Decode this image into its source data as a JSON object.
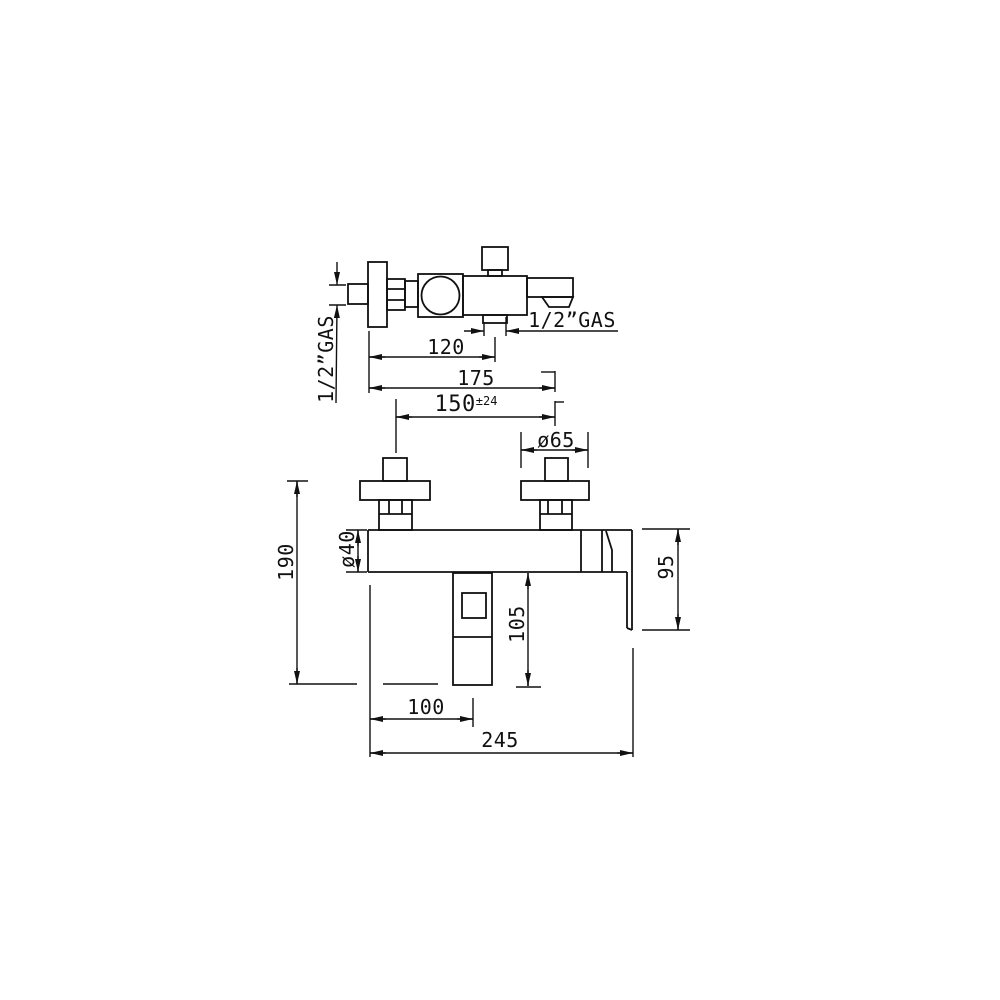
{
  "drawing_labels": {
    "inlet_connection_size": "1/2”GAS",
    "shower_outlet_connection_size": "1/2”GAS",
    "wall_to_shower_outlet_depth": "120",
    "wall_to_spout_depth": "175",
    "inlet_centers_distance": "150",
    "inlet_centers_tolerance": "±24",
    "rosette_diameter": "ø65",
    "body_diameter": "ø40",
    "overall_height": "190",
    "body_handle_height": "95",
    "outlet_drop_height": "105",
    "wall_to_outlet_center": "100",
    "overall_width": "245"
  },
  "style_colors": {
    "line": "#111111",
    "background": "#ffffff"
  }
}
